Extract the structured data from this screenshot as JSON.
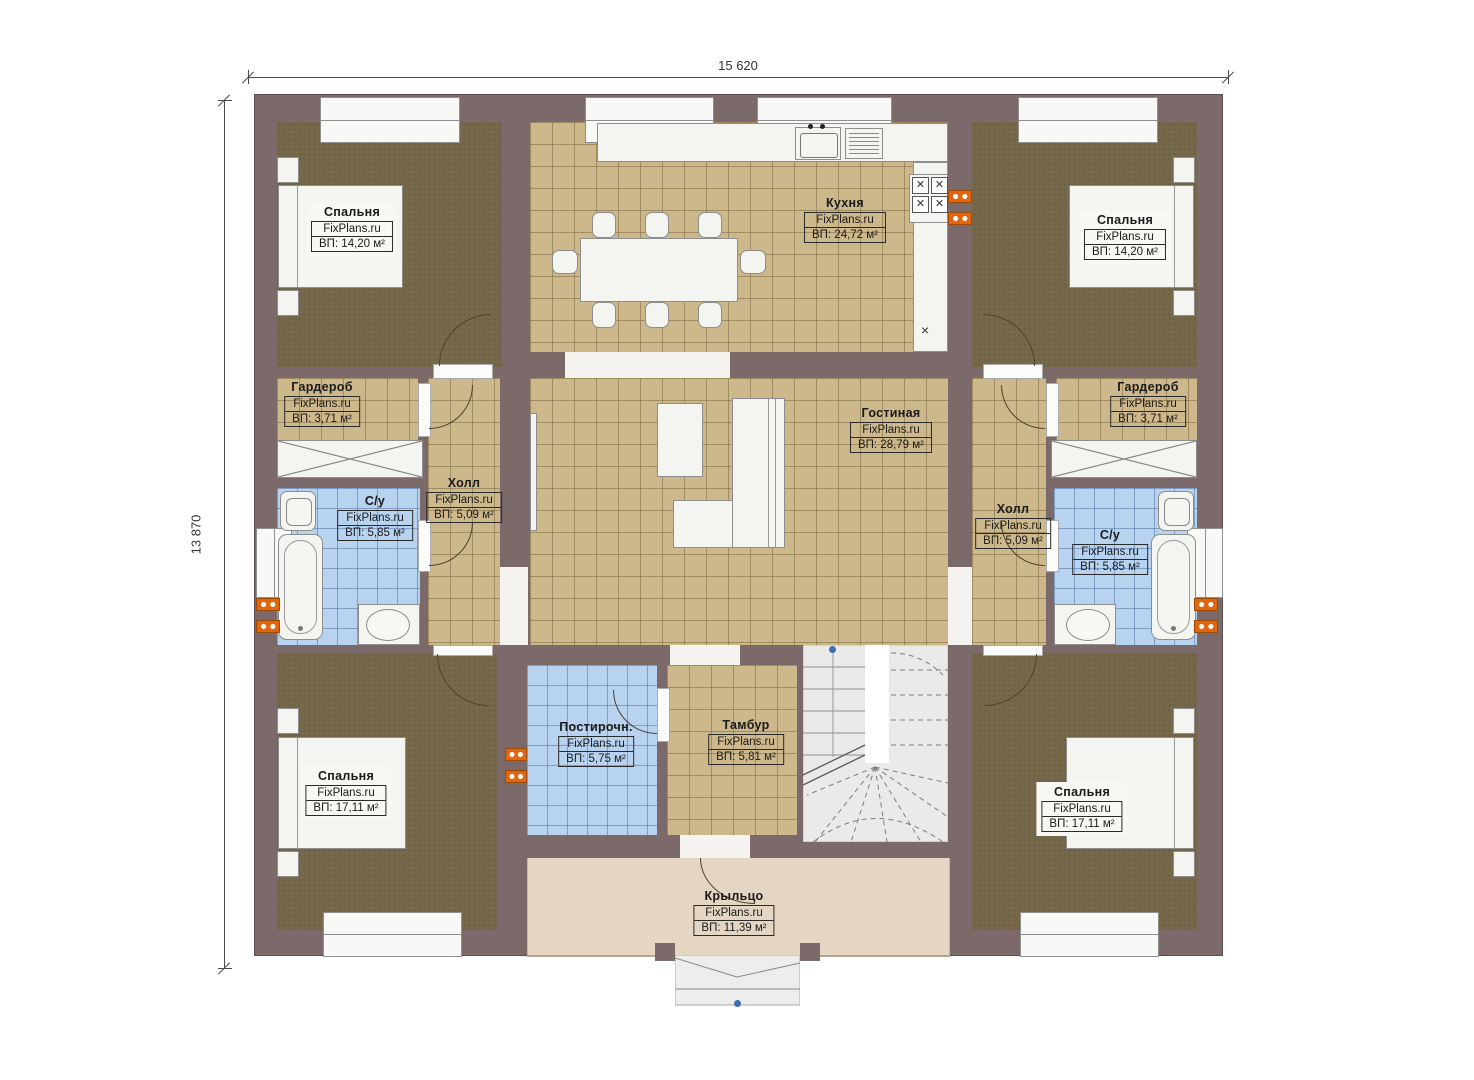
{
  "brand": "FixPlans.ru",
  "dimensions": {
    "width_label": "15 620",
    "height_label": "13 870"
  },
  "rooms": {
    "bedroom_tl": {
      "name": "Спальня",
      "area": "ВП: 14,20 м²"
    },
    "kitchen": {
      "name": "Кухня",
      "area": "ВП: 24,72 м²"
    },
    "bedroom_tr": {
      "name": "Спальня",
      "area": "ВП: 14,20 м²"
    },
    "garderob_left": {
      "name": "Гардероб",
      "area": "ВП: 3,71 м²"
    },
    "hall_left": {
      "name": "Холл",
      "area": "ВП: 5,09 м²"
    },
    "su_left": {
      "name": "С/у",
      "area": "ВП: 5,85 м²"
    },
    "living": {
      "name": "Гостиная",
      "area": "ВП: 28,79 м²"
    },
    "hall_right": {
      "name": "Холл",
      "area": "ВП: 5,09 м²"
    },
    "garderob_right": {
      "name": "Гардероб",
      "area": "ВП: 3,71 м²"
    },
    "su_right": {
      "name": "С/у",
      "area": "ВП: 5,85 м²"
    },
    "bedroom_bl": {
      "name": "Спальня",
      "area": "ВП: 17,11 м²"
    },
    "laundry": {
      "name": "Постирочн.",
      "area": "ВП: 5,75 м²"
    },
    "tambur": {
      "name": "Тамбур",
      "area": "ВП: 5,81 м²"
    },
    "bedroom_br": {
      "name": "Спальня",
      "area": "ВП: 17,11 м²"
    },
    "porch": {
      "name": "Крыльцо",
      "area": "ВП: 11,39 м²"
    }
  },
  "symbols": {
    "dishwasher_mark": "×",
    "burner_mark": "✕"
  },
  "colors": {
    "wall": "#7c6a6b",
    "carpet": "#76694b",
    "tile_tan": "#cdb88c",
    "tile_blue": "#b7d3f0",
    "porch": "#e4d6c3",
    "vent_orange": "#e2660d",
    "marker_blue": "#3a6fb5"
  }
}
